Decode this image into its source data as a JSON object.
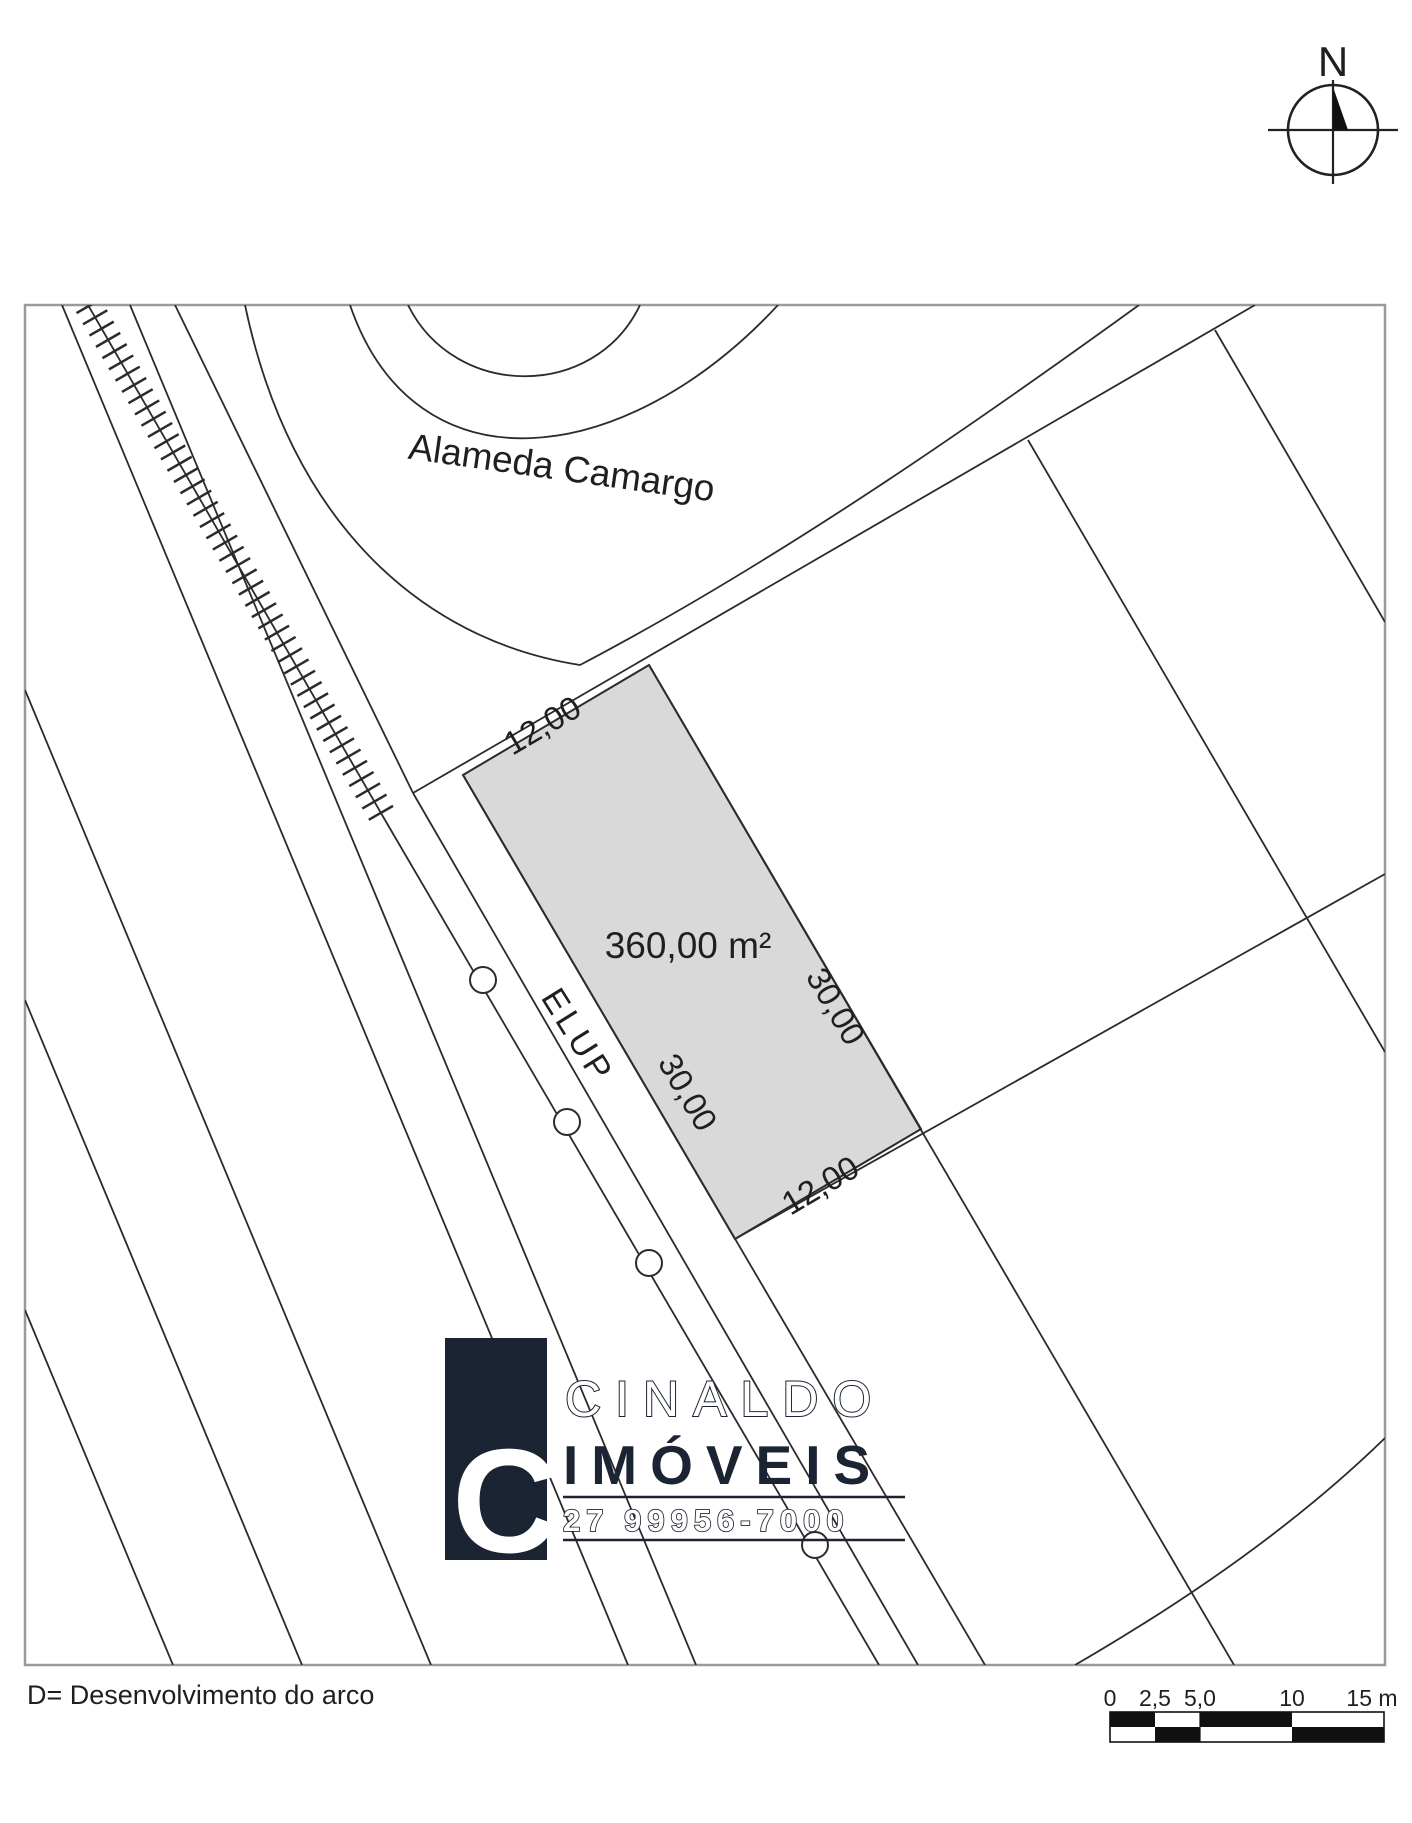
{
  "compass": {
    "north_label": "N"
  },
  "map": {
    "street_label": "Alameda Camargo",
    "strip_label": "ELUP",
    "lot": {
      "area_label": "360,00 m²",
      "front_label": "12,00",
      "back_label": "12,00",
      "left_label": "30,00",
      "right_label": "30,00",
      "fill_color": "#d9d9d9"
    }
  },
  "logo": {
    "name_line1": "CINALDO",
    "name_line2": "IMÓVEIS",
    "phone": "27 99956-7000",
    "mark_letter": "C",
    "brand_color": "#1b2433"
  },
  "legend": {
    "text": "D= Desenvolvimento do arco"
  },
  "scale_bar": {
    "tick_labels": [
      "0",
      "2,5",
      "5,0",
      "10",
      "15 m"
    ]
  }
}
